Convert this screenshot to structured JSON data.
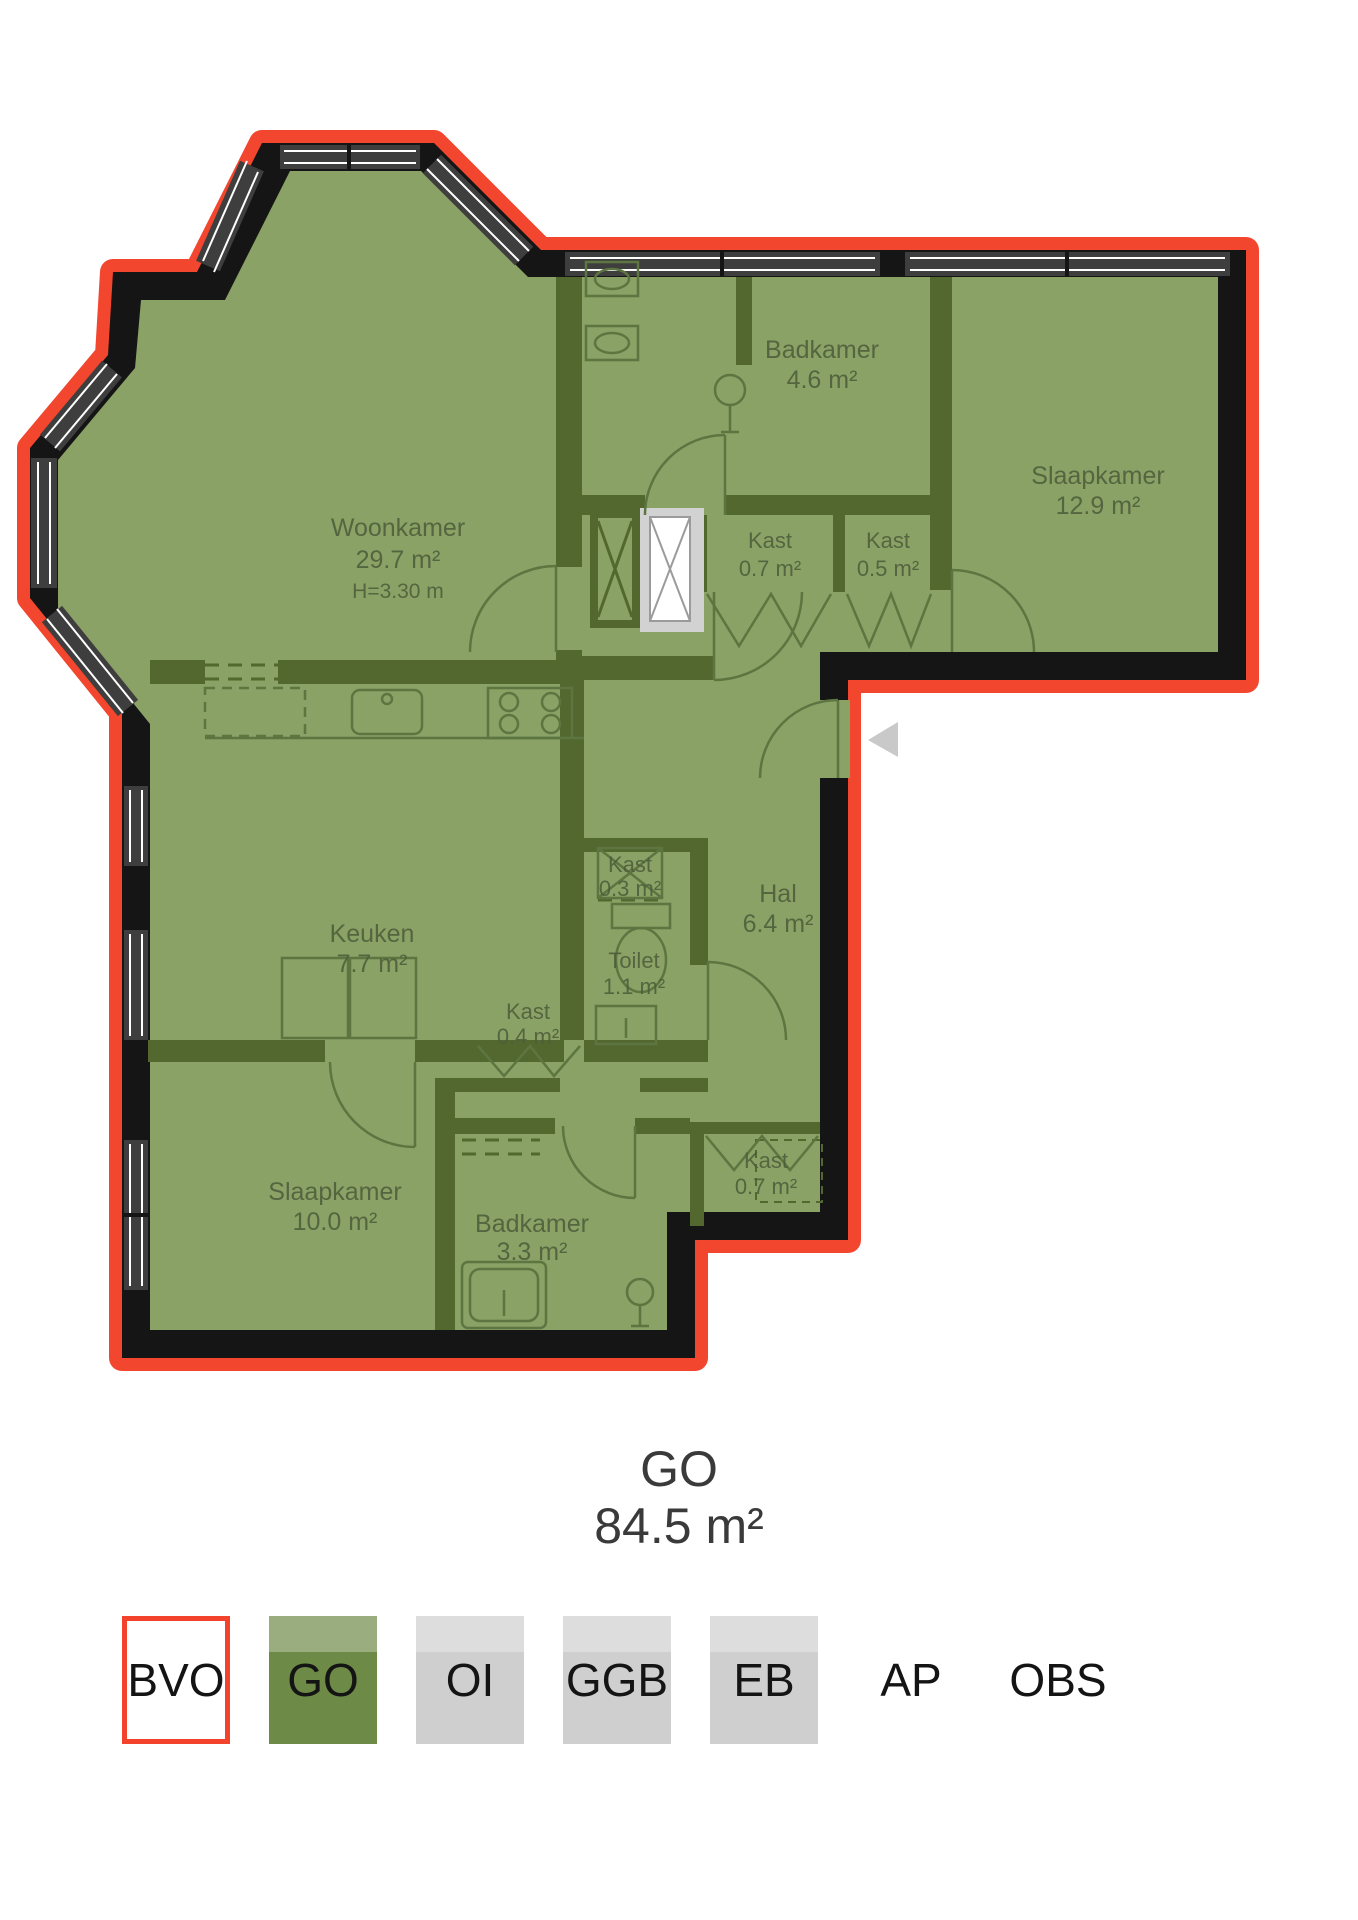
{
  "floorplan": {
    "rooms": [
      {
        "name": "Woonkamer",
        "area": "29.7 m²",
        "height_label": "H=3.30 m"
      },
      {
        "name": "Badkamer",
        "area": "4.6 m²"
      },
      {
        "name": "Slaapkamer",
        "area": "12.9 m²"
      },
      {
        "name": "Kast",
        "area": "0.7 m²"
      },
      {
        "name": "Kast",
        "area": "0.5 m²"
      },
      {
        "name": "Keuken",
        "area": "7.7 m²"
      },
      {
        "name": "Kast",
        "area": "0.3 m²"
      },
      {
        "name": "Hal",
        "area": "6.4 m²"
      },
      {
        "name": "Toilet",
        "area": "1.1 m²"
      },
      {
        "name": "Kast",
        "area": "0.4 m²"
      },
      {
        "name": "Slaapkamer",
        "area": "10.0 m²"
      },
      {
        "name": "Badkamer",
        "area": "3.3 m²"
      },
      {
        "name": "Kast",
        "area": "0.7 m²"
      }
    ],
    "colors": {
      "boundary_red": "#f2462e",
      "wall_black": "#151515",
      "plan_green": "#8aa265",
      "interior_wall_green": "#53682f",
      "window_gray": "#3e3e3e",
      "shaft_gray": "#d2d2d2",
      "entrance_marker_gray": "#c9c9c9"
    }
  },
  "summary": {
    "label": "GO",
    "area": "84.5 m²"
  },
  "legend": {
    "items": [
      {
        "label": "BVO",
        "style": "outline"
      },
      {
        "label": "GO",
        "style": "green"
      },
      {
        "label": "OI",
        "style": "gray"
      },
      {
        "label": "GGB",
        "style": "gray"
      },
      {
        "label": "EB",
        "style": "gray"
      },
      {
        "label": "AP",
        "style": "none"
      },
      {
        "label": "OBS",
        "style": "none"
      }
    ]
  }
}
